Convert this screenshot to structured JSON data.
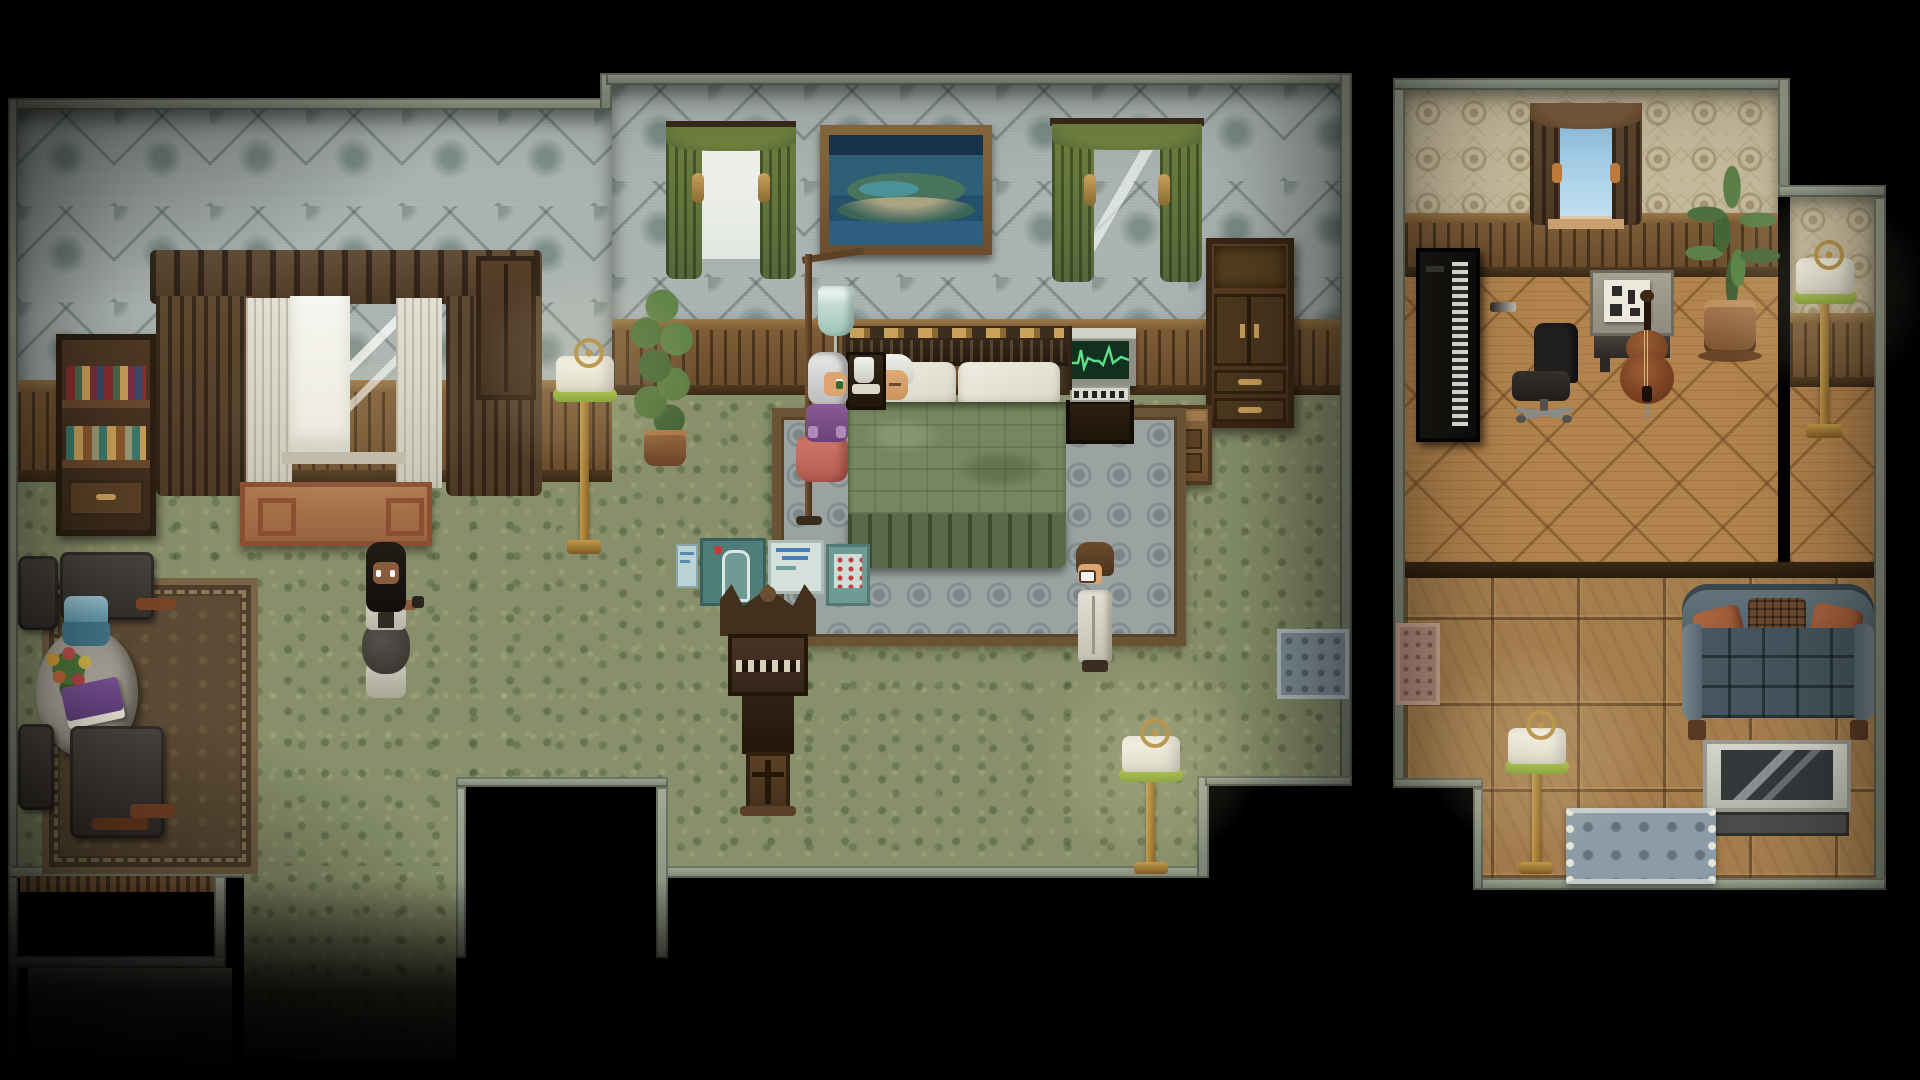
{
  "meta": {
    "title": "Pixel-art RPG interior — bedside scene",
    "style": "top-down 2D RPG (RPG-Maker style)",
    "visible_text": [],
    "rooms_count": 2
  },
  "palette": {
    "wallMain": "#a9b2b0",
    "wallStudy": "#c6ba9c",
    "carpet": "#87906a",
    "parquet": "#b2834c",
    "tiles": "#a57e4e",
    "stoneBorder": "#8d947f",
    "wainscot": "#6a4c2c",
    "blanket": "#76865f",
    "bedSkirt": "#5a694a",
    "pillow": "#eceade",
    "headboard": "#2c2118",
    "ekgScreen": "#12301f",
    "ekgLine": "#5ce08a",
    "ivBag": "#c2dad2",
    "curtainGreen": "#66793f",
    "drapeBrown": "#55422d",
    "lampGold": "#b08b3e",
    "lampShade": "#f2f0e6",
    "lampGreenRim": "#8fae3f",
    "couchFrame": "#5d6e76",
    "couchSeat": "#46565e",
    "cushionOrange": "#a2603c",
    "tvFrame": "#cdccc2",
    "tvScreen": "#34393b",
    "screenTeal": "#4e7d7a",
    "paintingSea": "#2e6077",
    "black": "#000000"
  },
  "rooms": [
    {
      "name": "master-bedroom",
      "walls": "gray-blue damask wallpaper over wood wainscot",
      "floor": "mottled green carpet"
    },
    {
      "name": "study",
      "walls": "tan medallion wallpaper over wood wainscot",
      "floor": "parquet upper half, square tile lower half"
    }
  ],
  "characters": [
    {
      "name": "caretaker",
      "desc": "dark-skinned woman, long black hair, white and charcoal uniform with gold trim, gray skirt, facing south",
      "facing": "south"
    },
    {
      "name": "elderly-woman",
      "desc": "silver-haired woman in purple blouse and rose skirt standing at left bedside by the IV stand",
      "facing": "east"
    },
    {
      "name": "sleeping-elder",
      "desc": "white-haired elderly man asleep on the left pillow of the double bed",
      "facing": "up"
    },
    {
      "name": "doctor",
      "desc": "man with brown hair and glasses in a long white coat at the right bedside",
      "facing": "west"
    }
  ],
  "devices": {
    "ekg_monitor": {
      "status": "active",
      "display": "green heartbeat trace"
    },
    "iv_drip": {
      "bag": "pale teal drip bag on wooden stand",
      "line": "tube running toward bed"
    }
  },
  "furniture": {
    "master_bedroom": [
      "bookshelf with red and green books",
      "large draped window with two panes",
      "sideboard table under window",
      "floor lamp",
      "potted plant",
      "green-curtained window (bright)",
      "framed island painting",
      "green-curtained window (sky)",
      "tall armoire with gold handles",
      "dresser",
      "EKG monitor station",
      "double bed with green blanket",
      "bedside nightstand with white pitcher",
      "IV drip stand",
      "patterned area rug",
      "medical folding screen with body chart",
      "ornate high-back chair",
      "second floor lamp",
      "small blue mat",
      "dining rug",
      "round table",
      "teal table lamp",
      "flower bouquet",
      "purple book",
      "four dark chairs",
      "descending staircase",
      "gray door panel with emblem"
    ],
    "study": [
      "black media rack with CD column",
      "brown-curtained window",
      "desk with sheet music",
      "black office chair",
      "cello",
      "tall potted plant",
      "alcove floor lamp",
      "floor lamp",
      "blue couch with orange cushions",
      "television on stand",
      "fringed blue rug",
      "pink doormat",
      "stair notch"
    ]
  }
}
